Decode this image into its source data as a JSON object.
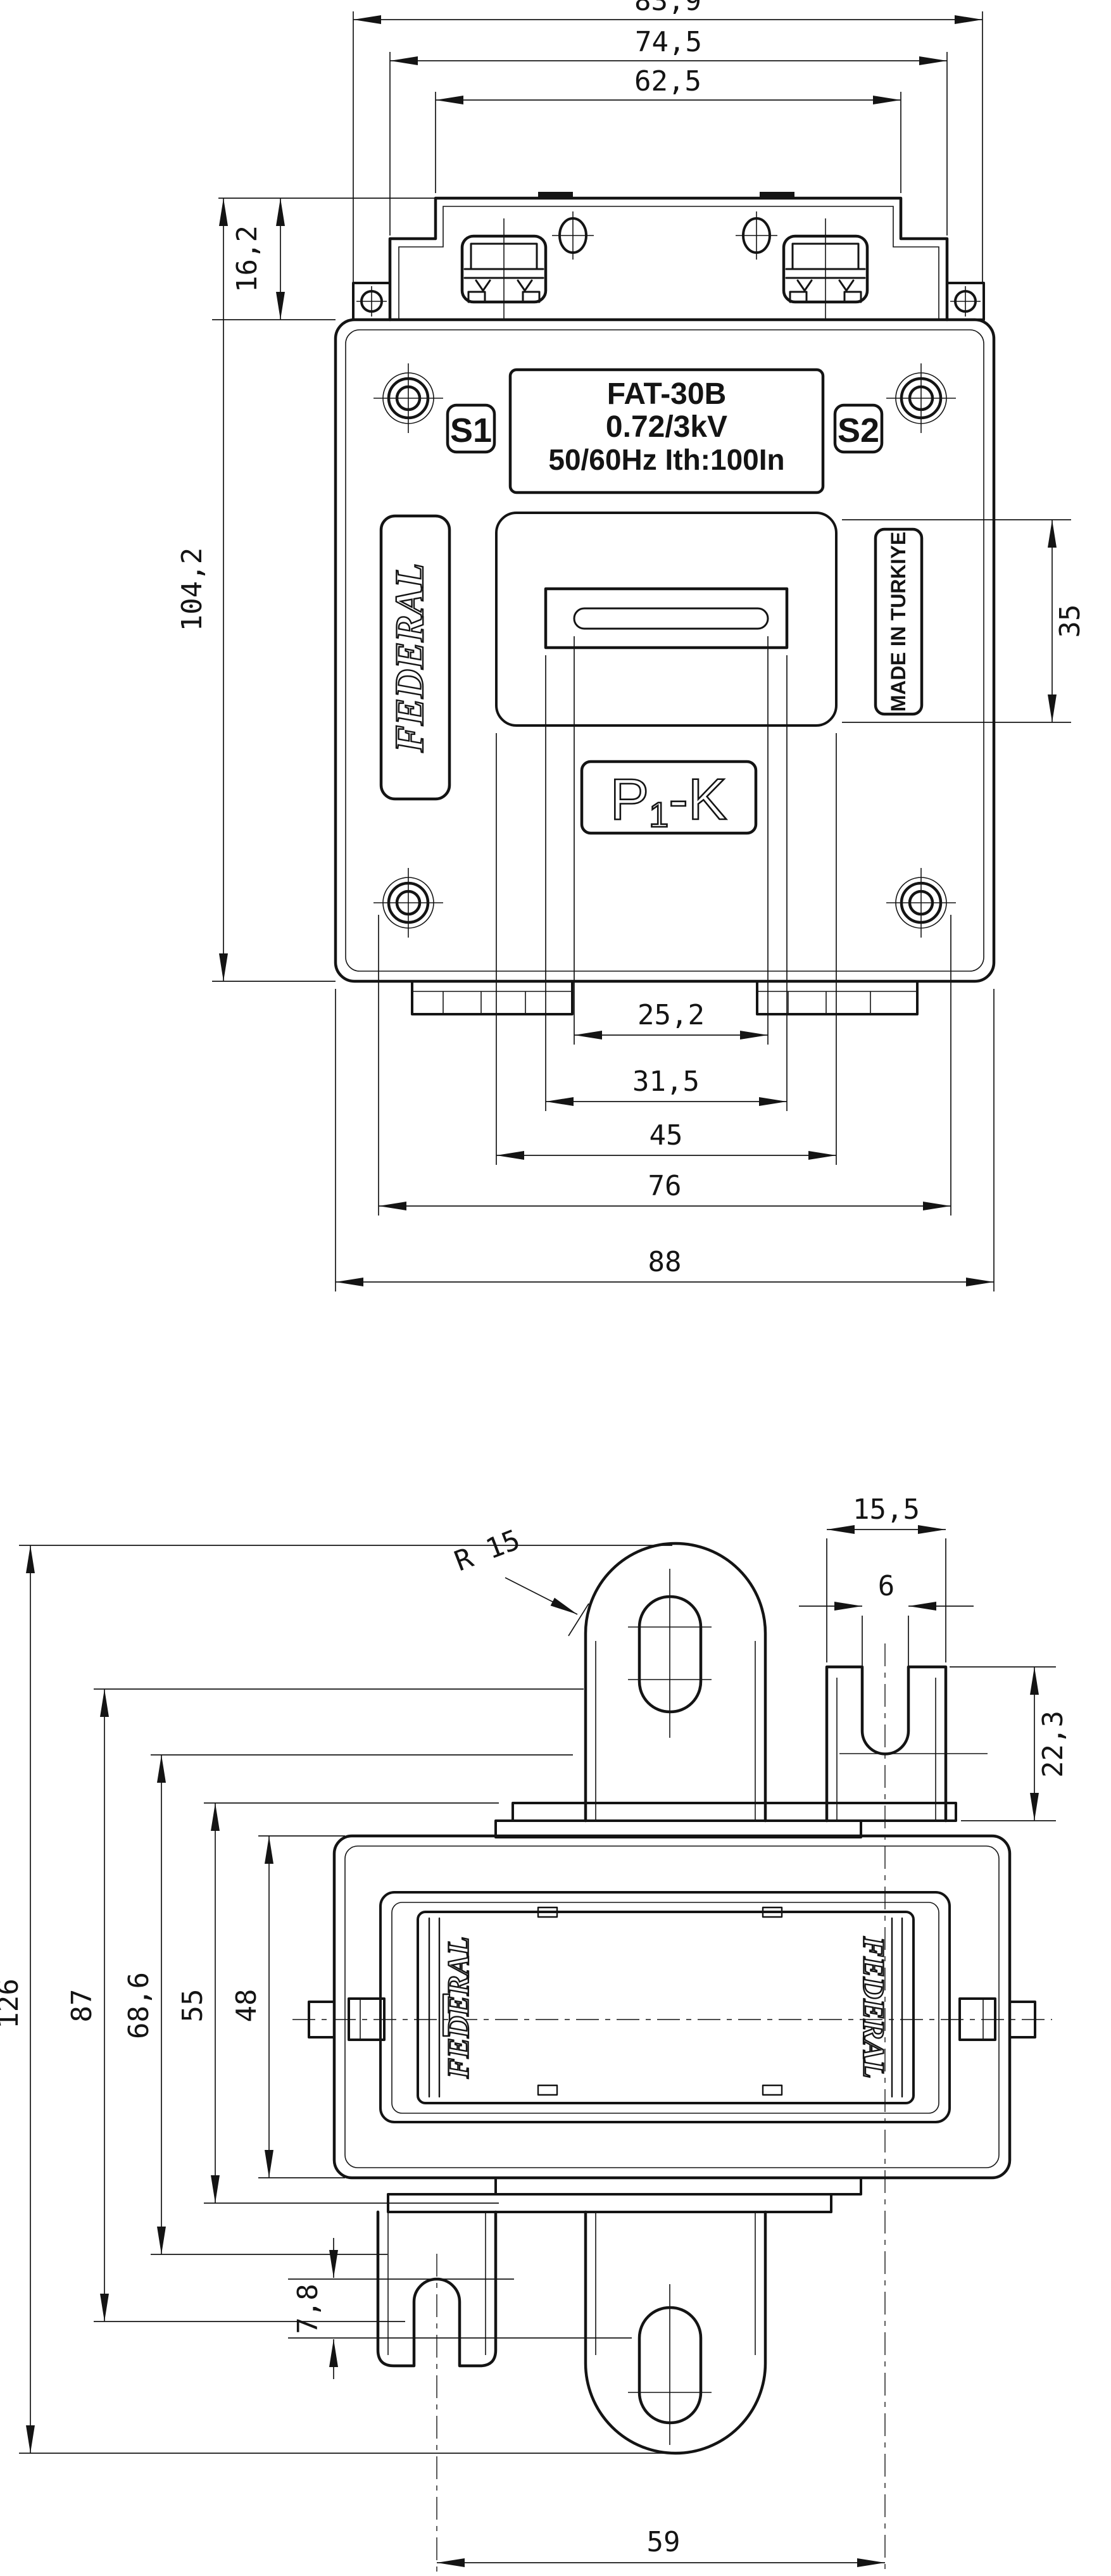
{
  "front_view": {
    "dim_top": {
      "d1": "83,9",
      "d2": "74,5",
      "d3": "62,5"
    },
    "dim_left": {
      "tab_height": "16,2",
      "total_height": "104,2"
    },
    "dim_right": {
      "window_height": "35"
    },
    "dim_bottom": {
      "d1": "25,2",
      "d2": "31,5",
      "d3": "45",
      "d4": "76",
      "d5": "88"
    },
    "nameplate": {
      "line1": "FAT-30B",
      "line2": "0.72/3kV",
      "line3": "50/60Hz Ith:100In"
    },
    "terminal_s1": "S1",
    "terminal_s2": "S2",
    "brand": "FEDERAL",
    "origin": "MADE IN TURKIYE",
    "polarity": {
      "p": "P",
      "sub": "1",
      "k": "-K"
    }
  },
  "side_view": {
    "dim_left": {
      "d1": "126",
      "d2": "87",
      "d3": "68,6",
      "d4": "55",
      "d5": "48"
    },
    "dim_top": {
      "terminal_width": "15,5",
      "slot_width": "6"
    },
    "dim_right": {
      "terminal_height": "22,3"
    },
    "dim_bottom": {
      "offset": "7,8",
      "spacing": "59"
    },
    "radius_note": "R 15",
    "brand_left": "FEDERAL",
    "brand_right": "FEDERAL"
  }
}
